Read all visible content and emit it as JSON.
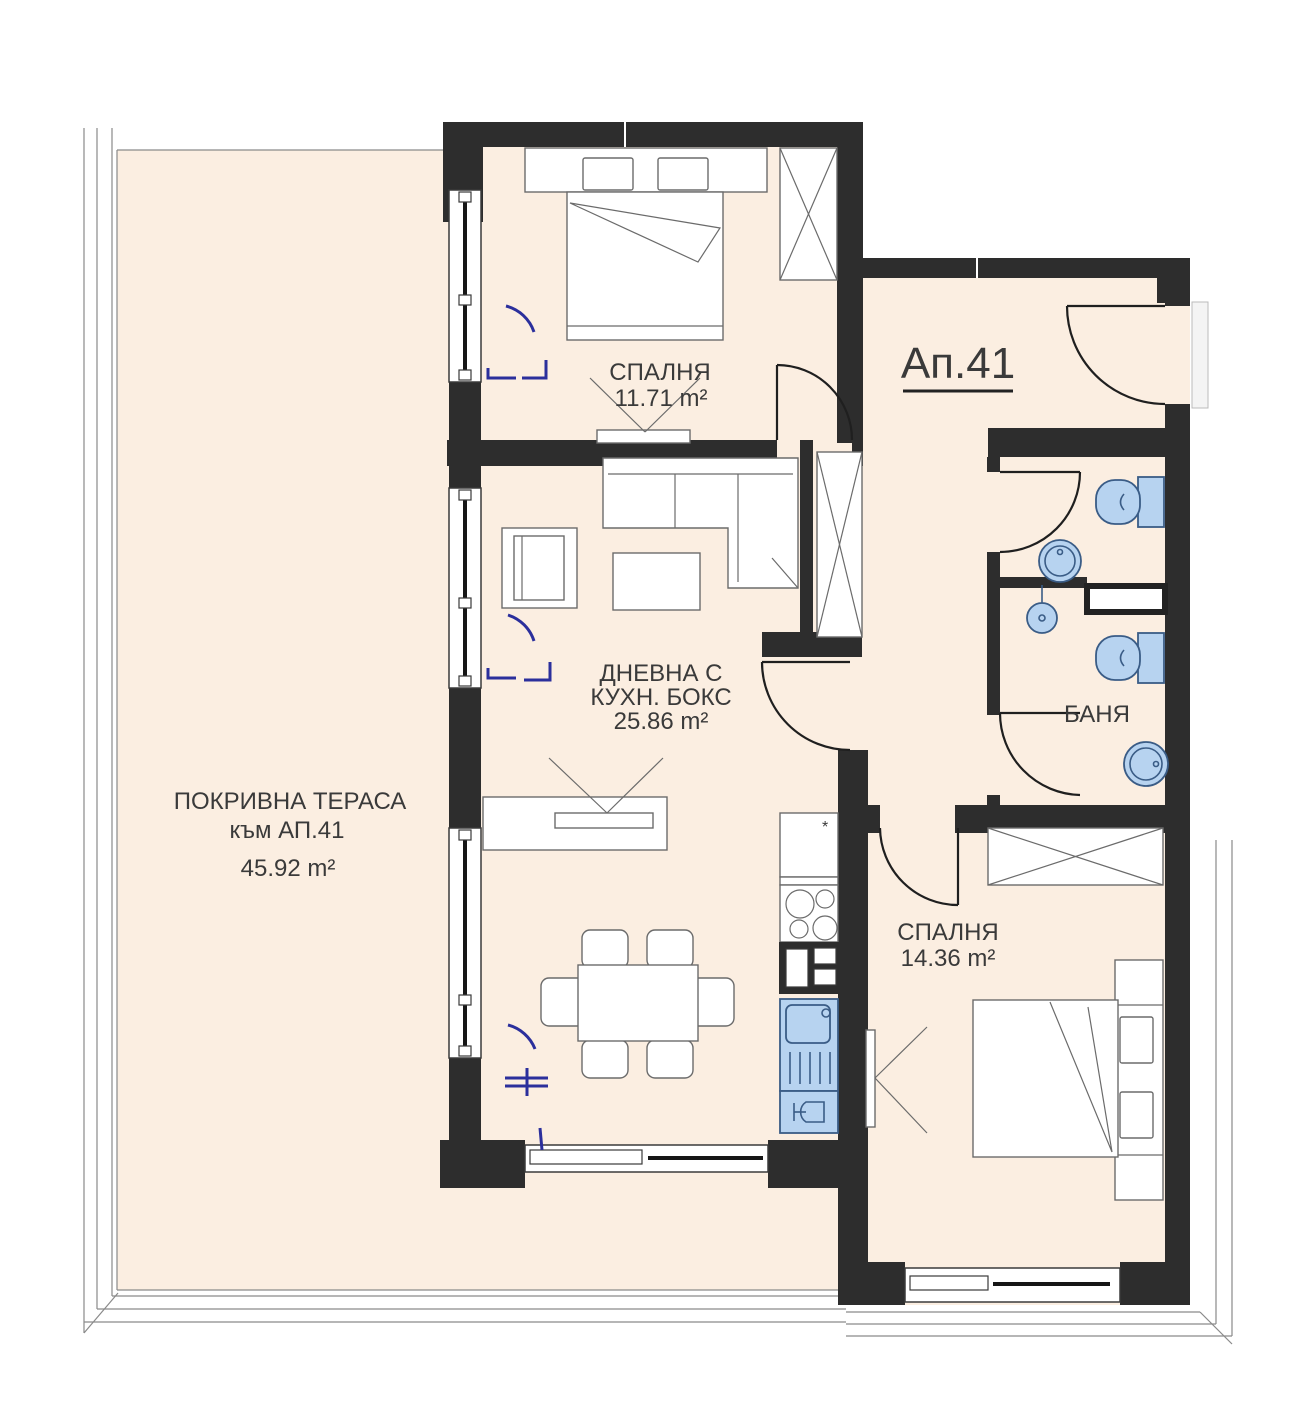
{
  "plan": {
    "apartment_label": "Ап.41",
    "rooms": {
      "bedroom_top": {
        "name": "СПАЛНЯ",
        "area": "11.71 m²"
      },
      "living": {
        "name_line1": "ДНЕВНА С",
        "name_line2": "КУХН. БОКС",
        "area": "25.86 m²"
      },
      "terrace": {
        "name": "ПОКРИВНА ТЕРАСА",
        "subtitle": "към АП.41",
        "area": "45.92 m²"
      },
      "bathroom": {
        "name": "БАНЯ"
      },
      "bedroom_bottom": {
        "name": "СПАЛНЯ",
        "area": "14.36 m²"
      }
    },
    "kitchen": {
      "fridge_mark": "*"
    },
    "colors": {
      "floor": "#fbeee1",
      "wall": "#2d2d2d",
      "fixture_fill": "#b7d3f0",
      "fixture_stroke": "#3a5c86",
      "indicator_blue": "#2b2f9c",
      "furniture_line": "#6b6b6b",
      "text": "#3a3a3a"
    }
  }
}
